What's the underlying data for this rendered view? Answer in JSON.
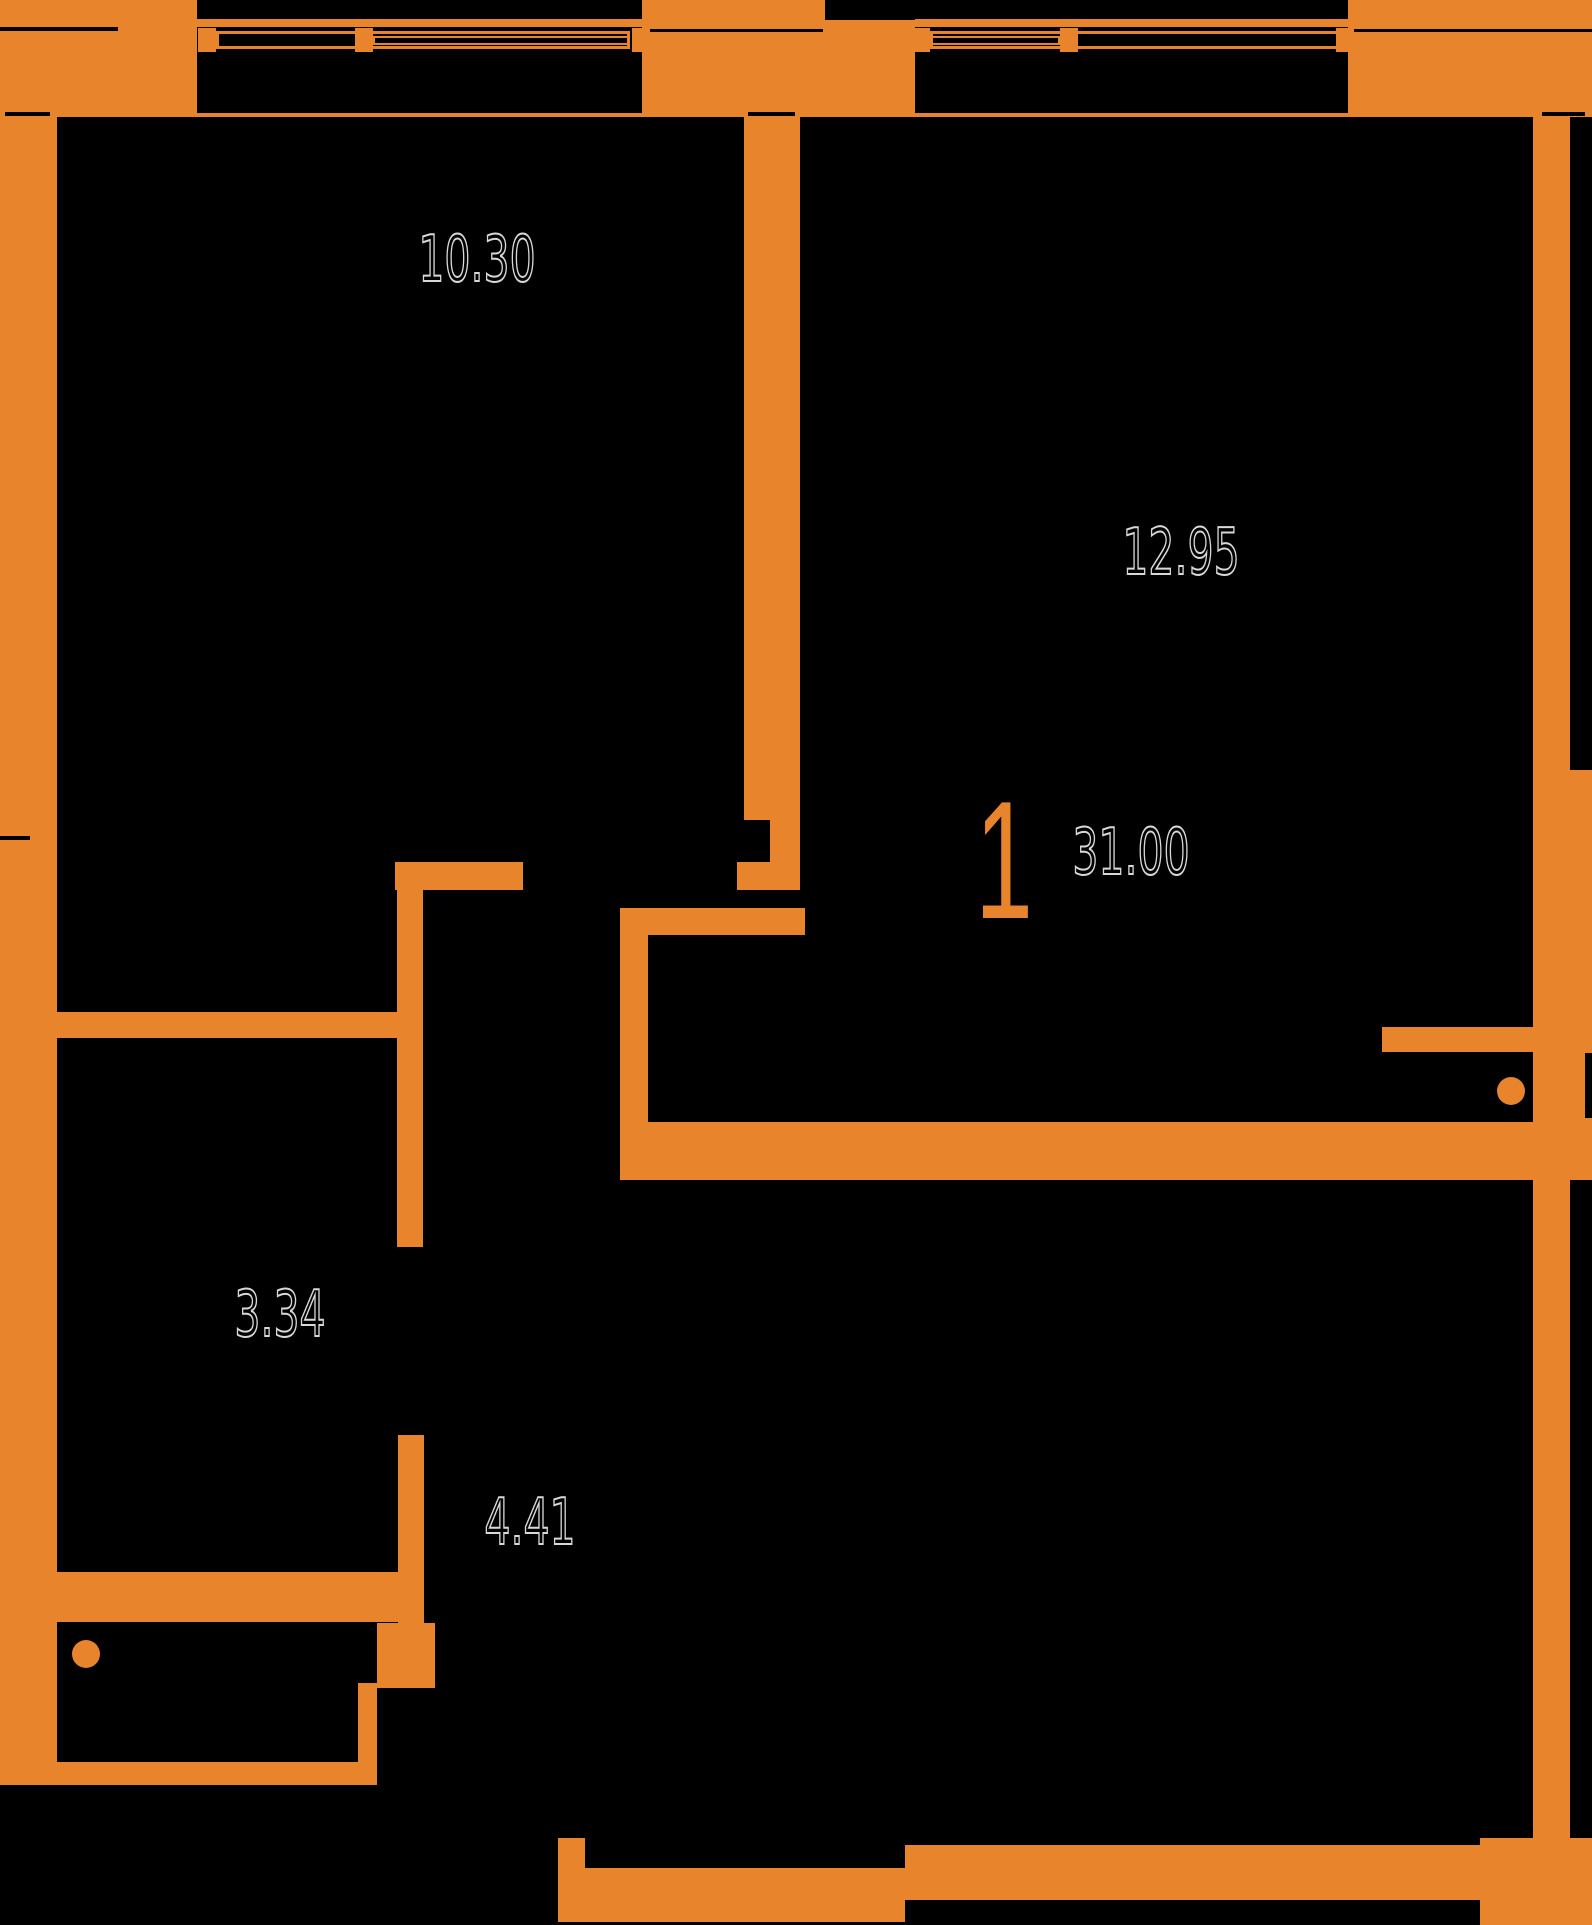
{
  "meta": {
    "title": "Apartment floor plan",
    "canvas": {
      "w": 1592,
      "h": 1925
    }
  },
  "colors": {
    "background": "#000000",
    "wall": "#E7842C",
    "label_fill": "#000000",
    "label_outline": "#D8D8D8",
    "accent": "#E7842C"
  },
  "labels": {
    "room_top_left_area": "10.30",
    "room_top_right_area": "12.95",
    "room_mid_left_area": "3.34",
    "hall_area": "4.41",
    "apartment_rooms": "1",
    "apartment_total_area": "31.00"
  },
  "plan": {
    "walls": [
      {
        "x": 0,
        "y": 0,
        "w": 197,
        "h": 117,
        "n": "corner-block-top-left"
      },
      {
        "x": 642,
        "y": 0,
        "w": 273,
        "h": 117,
        "n": "facade-pillar-top-middle"
      },
      {
        "x": 1348,
        "y": 0,
        "w": 244,
        "h": 117,
        "n": "corner-block-top-right"
      },
      {
        "x": 0,
        "y": 117,
        "w": 57,
        "h": 1668,
        "n": "wall-left-outer"
      },
      {
        "x": 1533,
        "y": 117,
        "w": 37,
        "h": 653,
        "n": "wall-right-outer-upper"
      },
      {
        "x": 1533,
        "y": 770,
        "w": 59,
        "h": 410,
        "n": "wall-right-outer-middle"
      },
      {
        "x": 1533,
        "y": 1180,
        "w": 37,
        "h": 665,
        "n": "wall-right-outer-lower"
      },
      {
        "x": 1480,
        "y": 1838,
        "w": 112,
        "h": 87,
        "n": "corner-block-bottom-right"
      },
      {
        "x": 744,
        "y": 117,
        "w": 56,
        "h": 703,
        "n": "wall-room-divider"
      },
      {
        "x": 770,
        "y": 820,
        "w": 30,
        "h": 42,
        "n": "wall-room-divider-step"
      },
      {
        "x": 737,
        "y": 862,
        "w": 63,
        "h": 28,
        "n": "wall-room-divider-cap"
      },
      {
        "x": 395,
        "y": 862,
        "w": 128,
        "h": 28,
        "n": "wall-room1-bottom"
      },
      {
        "x": 397,
        "y": 862,
        "w": 26,
        "h": 385,
        "n": "wall-hall-left-upper"
      },
      {
        "x": 57,
        "y": 1012,
        "w": 366,
        "h": 26,
        "n": "wall-room3-top"
      },
      {
        "x": 398,
        "y": 1435,
        "w": 26,
        "h": 188,
        "n": "wall-hall-left-lower"
      },
      {
        "x": 377,
        "y": 1623,
        "w": 58,
        "h": 65,
        "n": "wall-hall-left-block"
      },
      {
        "x": 358,
        "y": 1683,
        "w": 19,
        "h": 94,
        "n": "wall-vestibule-right"
      },
      {
        "x": 53,
        "y": 1762,
        "w": 324,
        "h": 23,
        "n": "wall-vestibule-bottom"
      },
      {
        "x": 57,
        "y": 1572,
        "w": 341,
        "h": 50,
        "n": "wall-room3-bottom-thick"
      },
      {
        "x": 620,
        "y": 908,
        "w": 185,
        "h": 27,
        "n": "wall-hall-right-top"
      },
      {
        "x": 620,
        "y": 935,
        "w": 28,
        "h": 187,
        "n": "wall-hall-right"
      },
      {
        "x": 620,
        "y": 1122,
        "w": 972,
        "h": 58,
        "n": "wall-hall-bottom-band"
      },
      {
        "x": 1382,
        "y": 1027,
        "w": 166,
        "h": 25,
        "n": "wall-entry-niche-top"
      },
      {
        "x": 558,
        "y": 1838,
        "w": 27,
        "h": 84,
        "n": "wall-bottom-left-cap"
      },
      {
        "x": 558,
        "y": 1868,
        "w": 347,
        "h": 54,
        "n": "wall-bottom-band-left"
      },
      {
        "x": 905,
        "y": 1845,
        "w": 628,
        "h": 55,
        "n": "wall-bottom-band-right"
      }
    ],
    "notches": [
      {
        "x": 0,
        "y": 27,
        "w": 118,
        "h": 4
      },
      {
        "x": 650,
        "y": 29,
        "w": 173,
        "h": 3
      },
      {
        "x": 1350,
        "y": 29,
        "w": 242,
        "h": 3
      },
      {
        "x": 5,
        "y": 112,
        "w": 45,
        "h": 4
      },
      {
        "x": 748,
        "y": 112,
        "w": 47,
        "h": 4
      },
      {
        "x": 1542,
        "y": 112,
        "w": 43,
        "h": 4
      },
      {
        "x": 0,
        "y": 836,
        "w": 30,
        "h": 4
      },
      {
        "x": 825,
        "y": 0,
        "w": 90,
        "h": 20
      },
      {
        "x": 1585,
        "y": 1053,
        "w": 7,
        "h": 65
      }
    ],
    "windows": [
      {
        "n": "window-top-left",
        "ledge": {
          "x": 197,
          "y": 19,
          "w": 445
        },
        "frame": {
          "x": 216,
          "y": 31,
          "w": 414,
          "h": 18
        },
        "sash": {
          "x": 373,
          "y": 36,
          "w": 257,
          "h": 9
        },
        "brackets": [
          {
            "x": 198,
            "y": 28
          },
          {
            "x": 355,
            "y": 28
          },
          {
            "x": 632,
            "y": 28
          }
        ],
        "face": {
          "x": 197,
          "y": 113,
          "w": 445
        }
      },
      {
        "n": "window-top-right",
        "ledge": {
          "x": 915,
          "y": 19,
          "w": 433
        },
        "frame": {
          "x": 930,
          "y": 31,
          "w": 412,
          "h": 18
        },
        "sash": {
          "x": 930,
          "y": 36,
          "w": 130,
          "h": 9
        },
        "brackets": [
          {
            "x": 912,
            "y": 28
          },
          {
            "x": 1060,
            "y": 28
          },
          {
            "x": 1336,
            "y": 28
          }
        ],
        "face": {
          "x": 915,
          "y": 113,
          "w": 433
        }
      }
    ],
    "circles": [
      {
        "cx": 86,
        "cy": 1654,
        "r": 14,
        "n": "fixture-dot-vestibule"
      },
      {
        "cx": 1511,
        "cy": 1091,
        "r": 14,
        "n": "fixture-dot-entry"
      }
    ],
    "label_positions": {
      "area-label-room-top-left": [
        477,
        260
      ],
      "area-label-room-top-right": [
        1181,
        553
      ],
      "apartment-unit-number": [
        1004,
        860
      ],
      "apartment-total-area": [
        1131,
        853
      ],
      "area-label-room-mid-left": [
        280,
        1315
      ],
      "area-label-hall": [
        530,
        1523
      ]
    }
  }
}
